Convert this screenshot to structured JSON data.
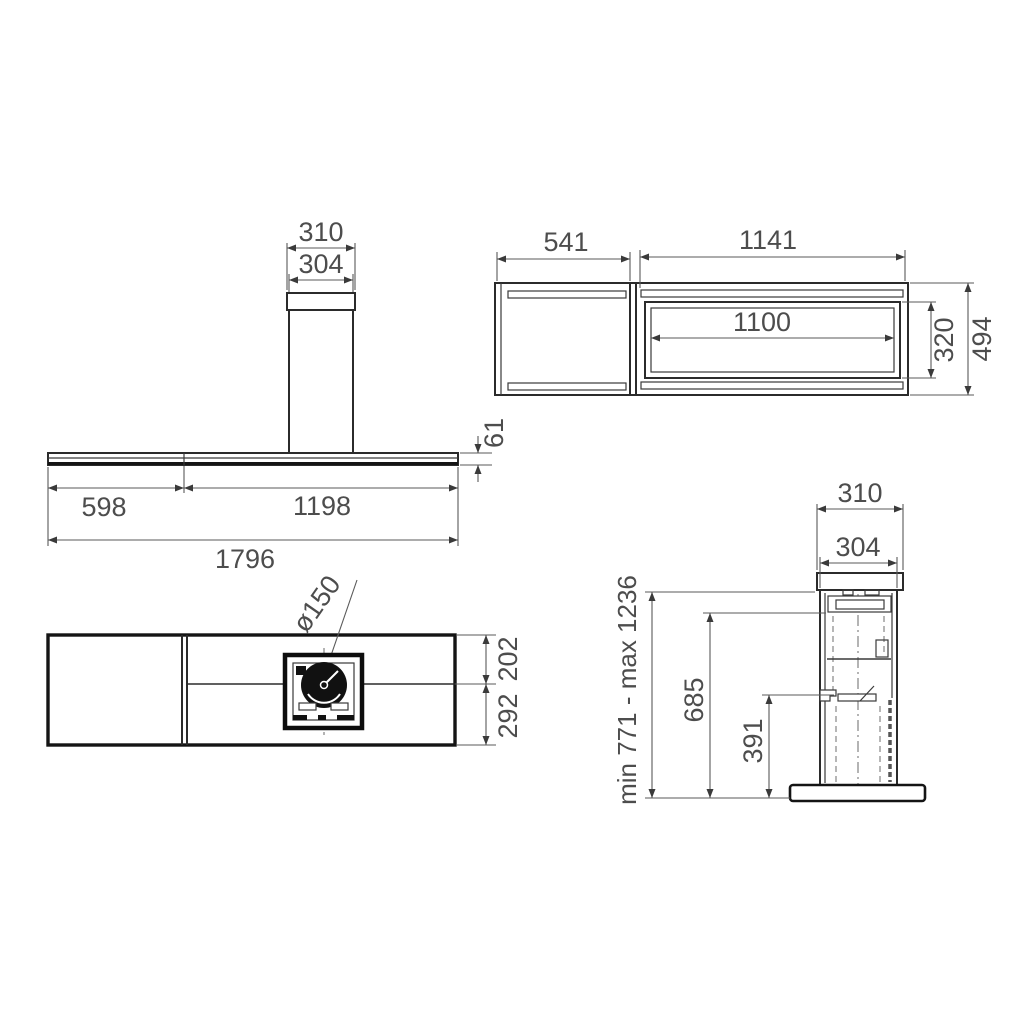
{
  "drawing": {
    "title": "cooker hood installation dimensions",
    "line_color": "#2b2b2b",
    "dim_text_color": "#4d4d4d",
    "views": {
      "front": {
        "dims": {
          "chimney_top_width": "310",
          "chimney_body_width": "304",
          "panel_left_width": "598",
          "panel_right_width": "1198",
          "total_width": "1796",
          "body_height": "61"
        }
      },
      "top": {
        "dims": {
          "left_section_width": "541",
          "right_section_width": "1141",
          "cutout_width": "1100",
          "cutout_depth": "320",
          "total_depth": "494"
        }
      },
      "bottom": {
        "dims": {
          "outlet_diameter": "ø150",
          "front_depth": "202",
          "rear_depth": "292"
        }
      },
      "side": {
        "dims": {
          "chimney_top_width": "310",
          "chimney_body_width": "304",
          "height_range": "min 771 - max 1236",
          "chimney_height": "685",
          "lower_clearance": "391"
        }
      }
    }
  }
}
